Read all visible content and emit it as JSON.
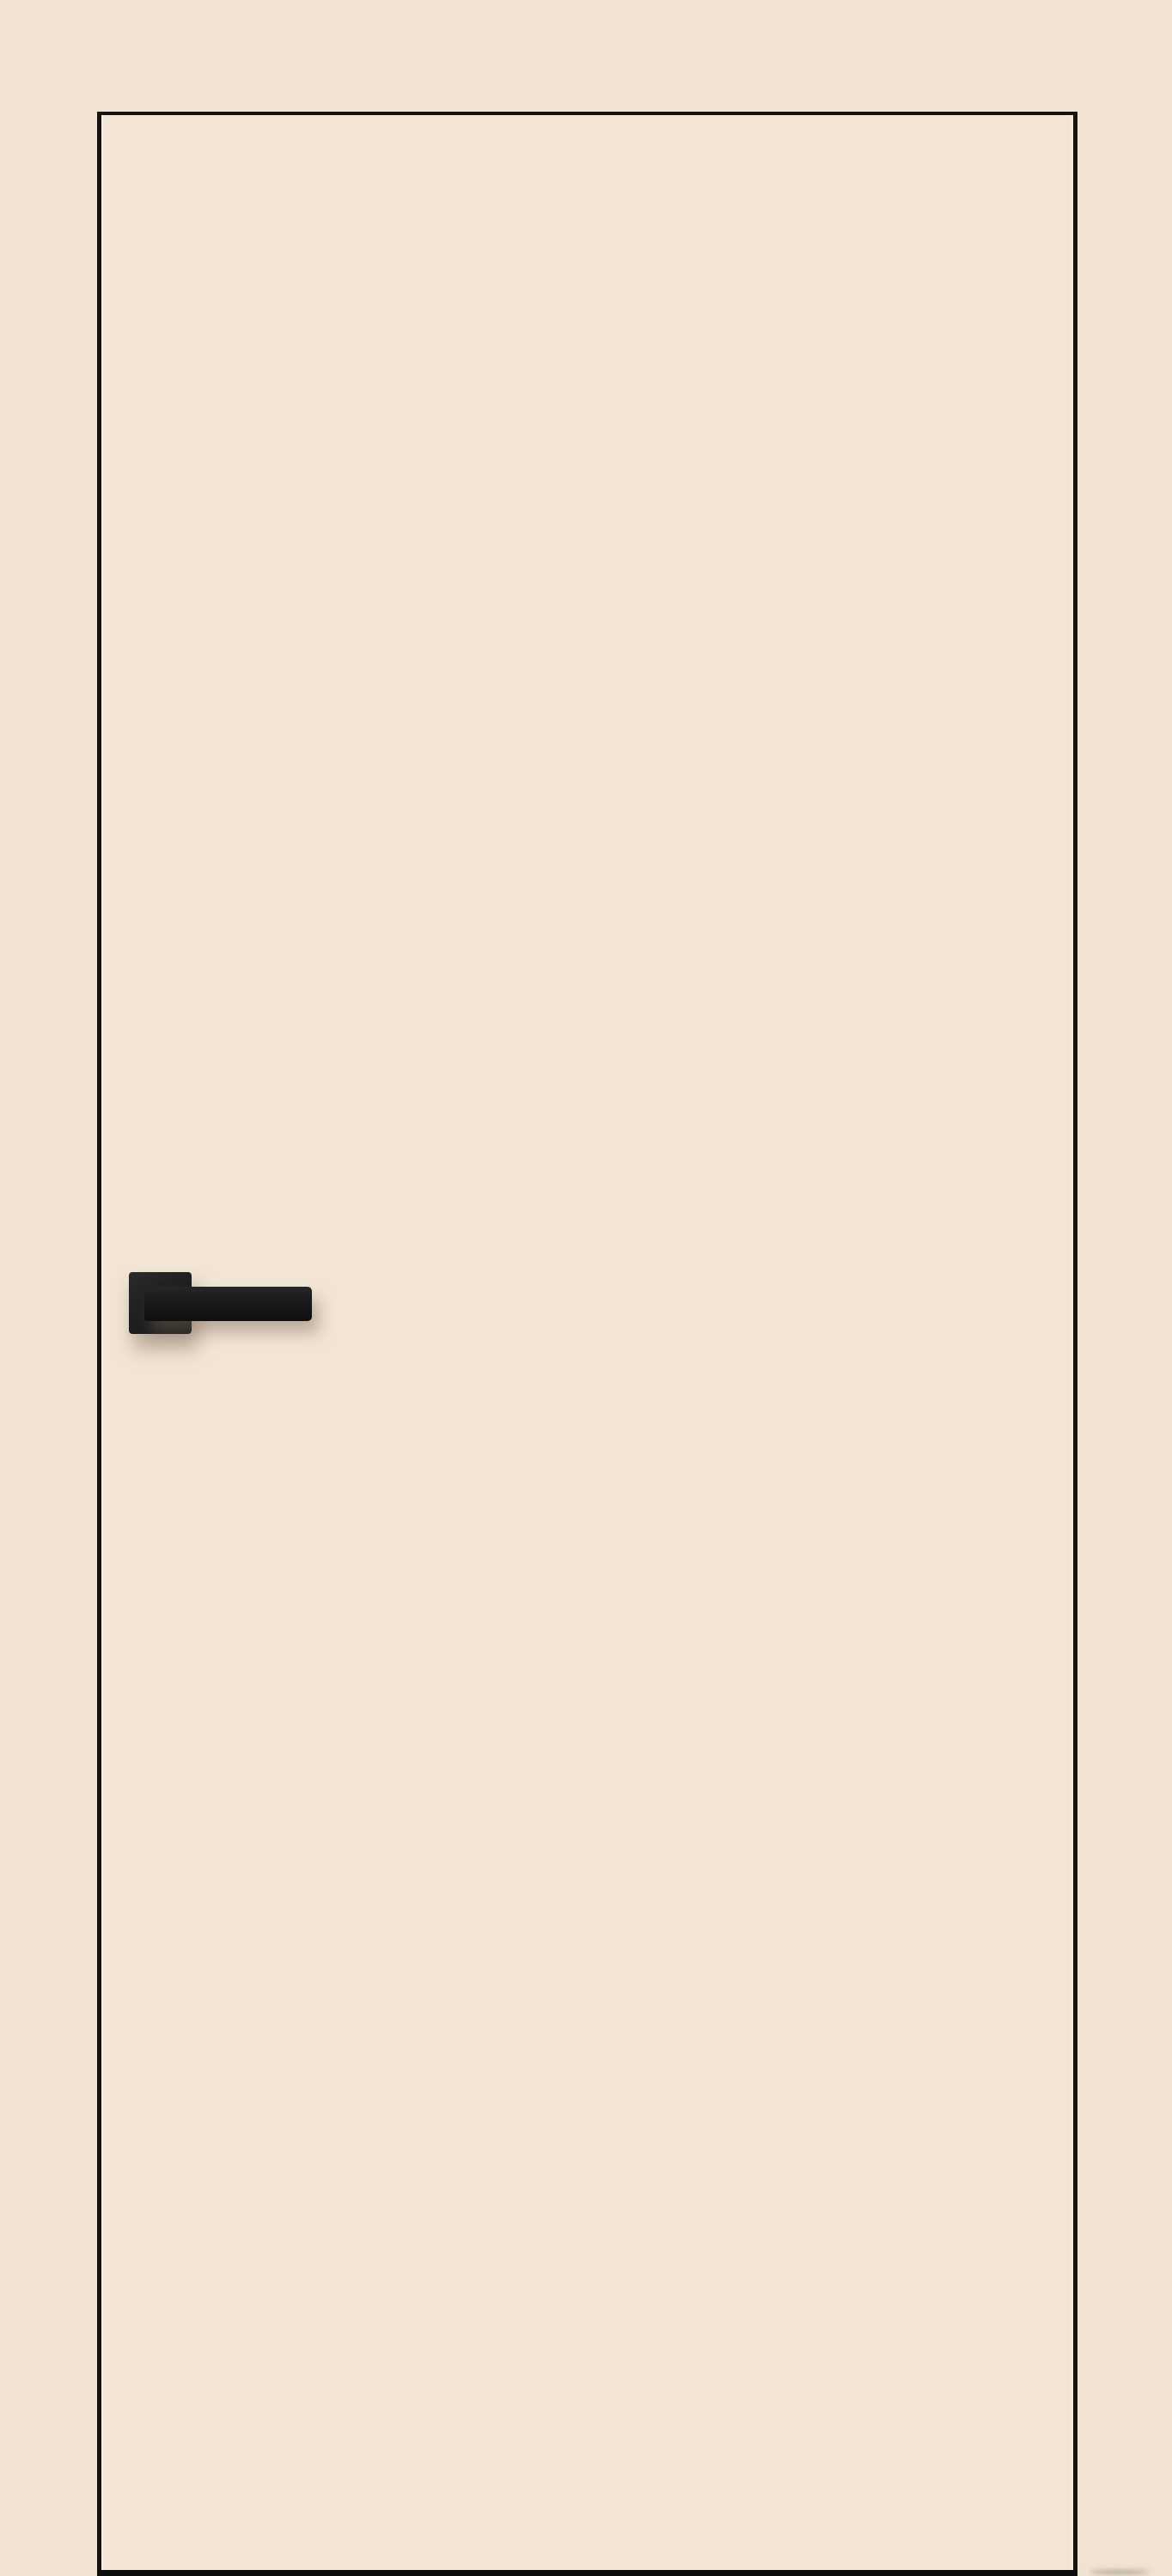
{
  "scene": {
    "background_color": "#f0e3d2",
    "door_face_color": "#f2e5d5",
    "door_edge_color": "#141414",
    "door_bottom_edge_color": "#0d0d0d",
    "rosette_color": "#202020",
    "lever_color": "#181818",
    "shadow_color": "rgba(124, 106, 88, 0.45)"
  }
}
